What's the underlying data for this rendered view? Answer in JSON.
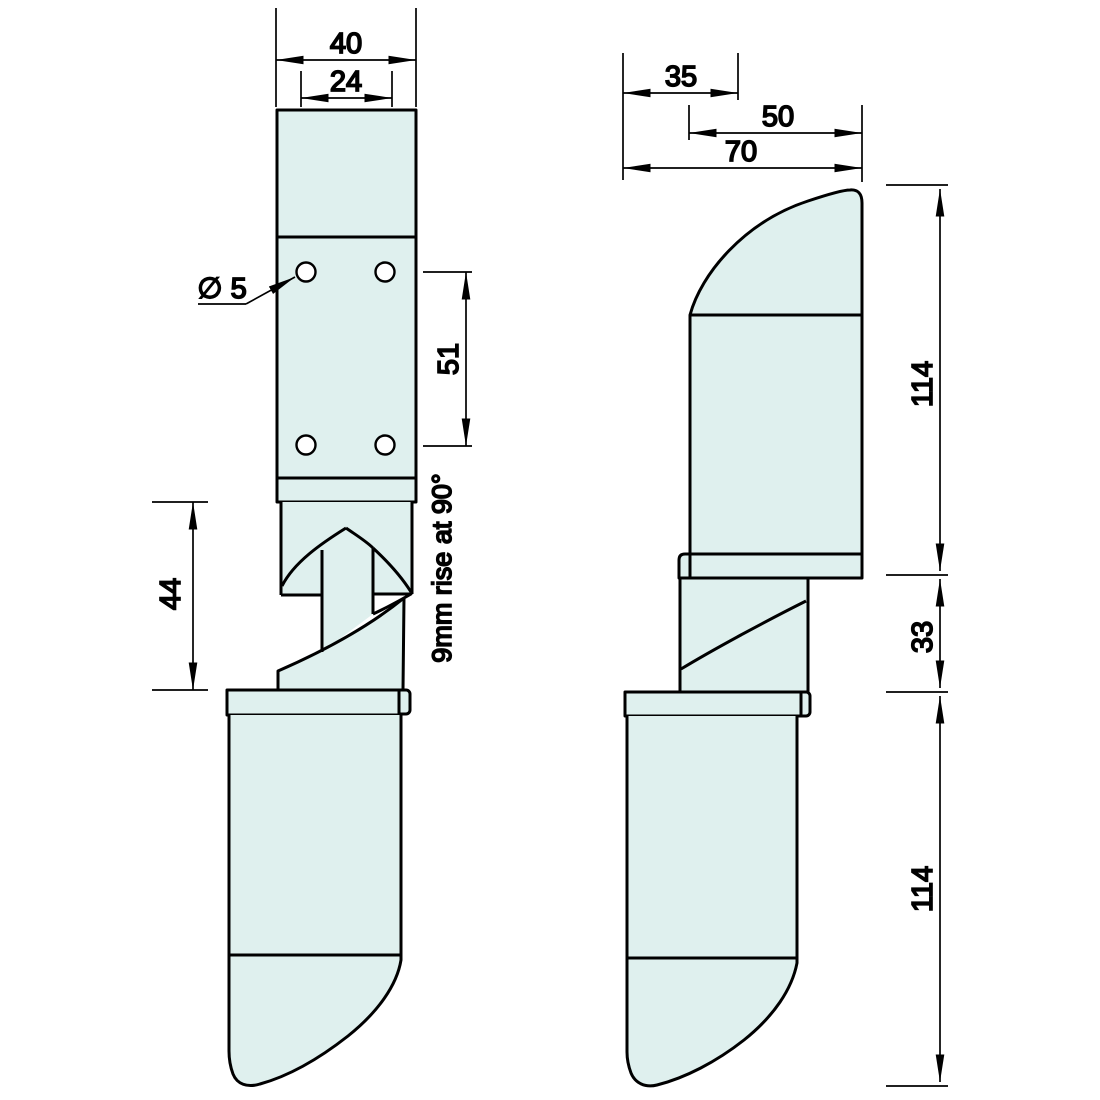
{
  "colors": {
    "fill": "#dff0ee",
    "line": "#000000"
  },
  "front_view": {
    "dim_overall_width": "40",
    "dim_hole_spacing_x": "24",
    "hole_diameter_label": "∅ 5",
    "dim_hole_spacing_y": "51",
    "dim_knuckle_height": "44",
    "rise_note": "9mm rise at 90°"
  },
  "side_view": {
    "dim_flap_offset": "35",
    "dim_flap_width": "50",
    "dim_overall_depth": "70",
    "dim_upper_flap_height": "114",
    "dim_knuckle_height": "33",
    "dim_lower_flap_height": "114"
  }
}
